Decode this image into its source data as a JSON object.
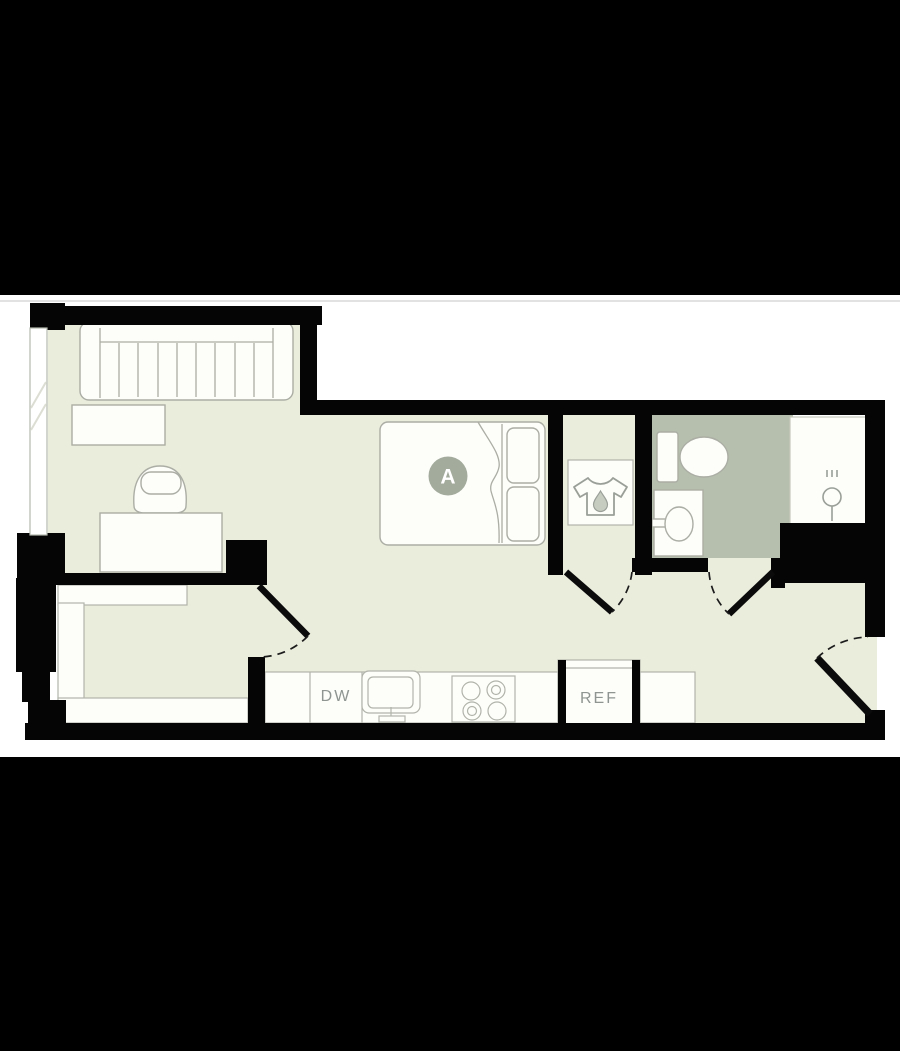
{
  "letterbox": {
    "top_color": "#000000",
    "bottom_color": "#000000",
    "divider_color": "#d9d9d9"
  },
  "floorplan": {
    "unit_badge": "A",
    "labels": {
      "dishwasher": "DW",
      "refrigerator": "REF"
    },
    "colors": {
      "wall": "#050505",
      "floor": "#eaecdc",
      "bathroom_floor": "#b6bfad",
      "fixture_stroke": "#abaea4",
      "label_text": "#8f9691",
      "unit_badge_fill": "#a3ab9d",
      "unit_badge_text": "#ffffff"
    },
    "icons": [
      "laundry-shirt-icon",
      "water-drop-icon",
      "shower-head-icon"
    ],
    "fixtures": [
      "sofa",
      "coffee-table",
      "armchair",
      "desk",
      "bed",
      "pillows",
      "wardrobe",
      "closet-shelves",
      "dresser",
      "toilet",
      "vanity-sink",
      "shower",
      "kitchen-sink",
      "cooktop",
      "dishwasher",
      "refrigerator"
    ],
    "doors": 4,
    "windows": 1
  }
}
